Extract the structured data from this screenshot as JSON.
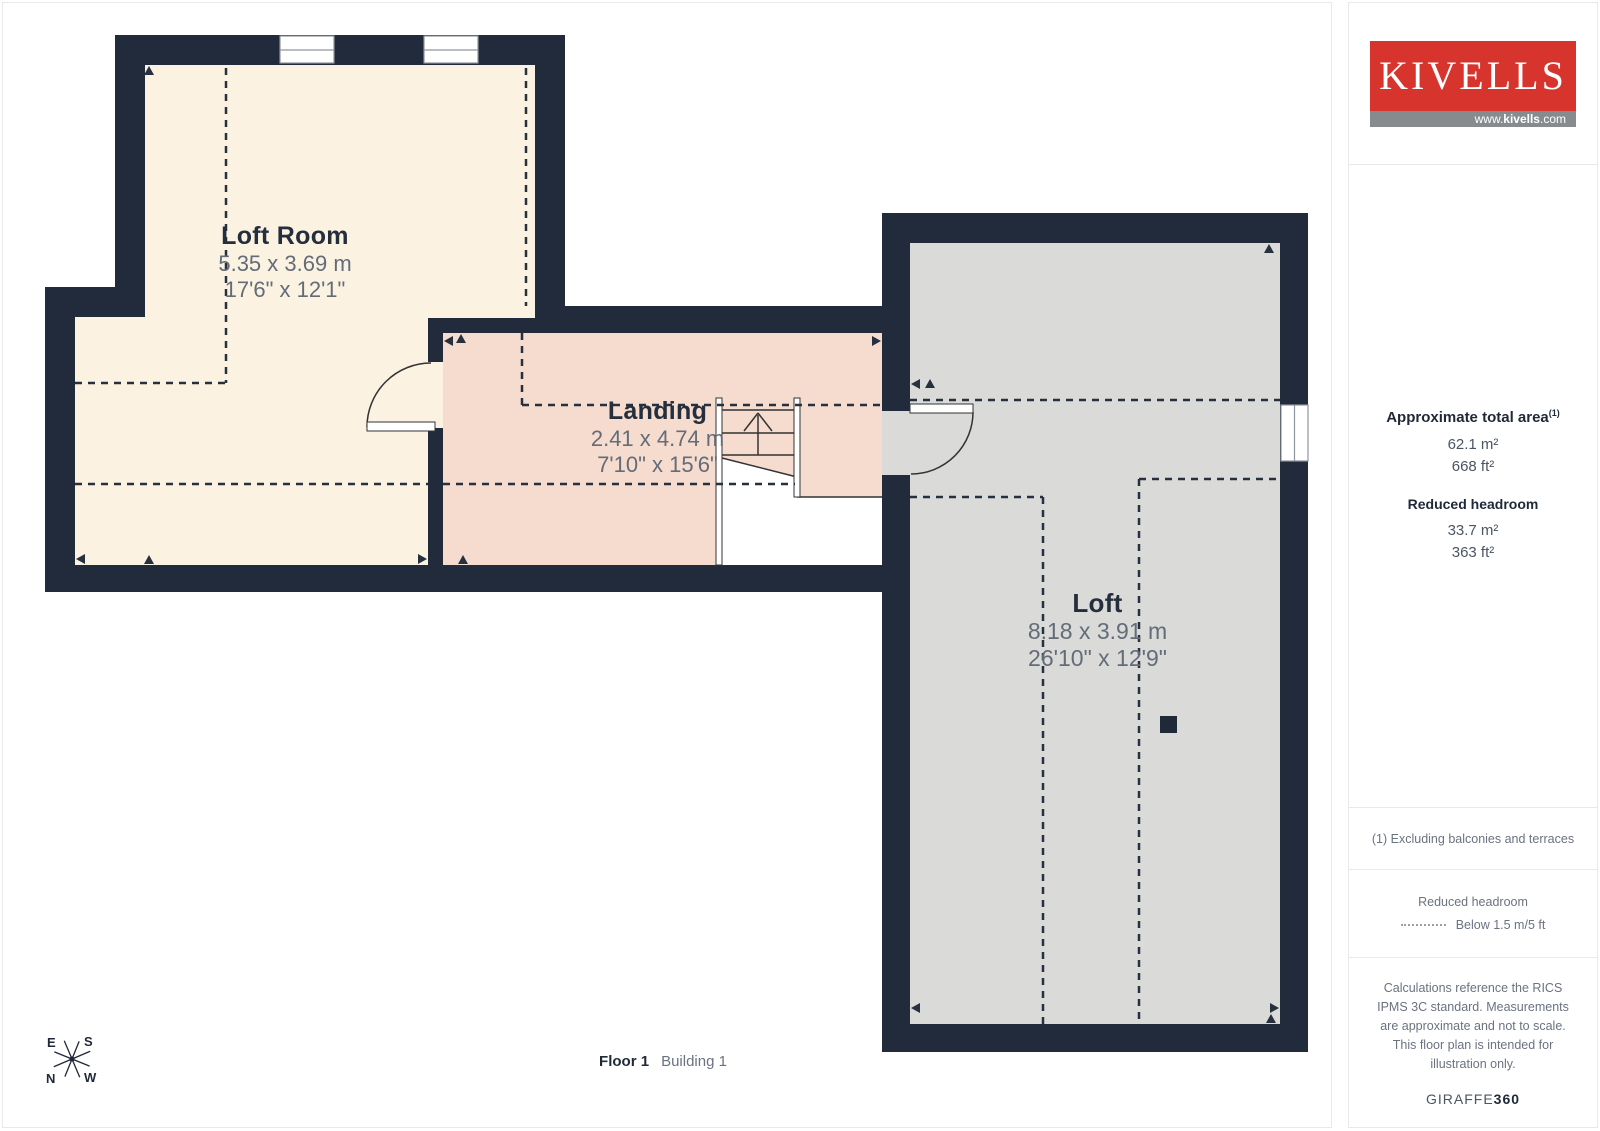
{
  "logo": {
    "brand": "KIVELLS",
    "website_prefix": "www.",
    "website_bold": "kivells",
    "website_suffix": ".com"
  },
  "rooms": [
    {
      "name": "Loft Room",
      "dim_metric": "5.35 x 3.69 m",
      "dim_imperial": "17'6\" x 12'1\""
    },
    {
      "name": "Landing",
      "dim_metric": "2.41 x 4.74 m",
      "dim_imperial": "7'10\" x 15'6\""
    },
    {
      "name": "Loft",
      "dim_metric": "8.18 x 3.91 m",
      "dim_imperial": "26'10\" x 12'9\""
    }
  ],
  "sidebar": {
    "area_title": "Approximate total area",
    "area_footnote_marker": "(1)",
    "area_m2": "62.1 m²",
    "area_ft2": "668 ft²",
    "reduced_headroom_title": "Reduced headroom",
    "reduced_m2": "33.7 m²",
    "reduced_ft2": "363 ft²",
    "footnote": "(1) Excluding balconies and terraces",
    "legend_title": "Reduced headroom",
    "legend_label": "Below 1.5 m/5 ft",
    "disclaimer": "Calculations reference the RICS IPMS 3C standard. Measurements are approximate and not to scale. This floor plan is intended for illustration only.",
    "credit_brand": "GIRAFFE",
    "credit_suffix": "360"
  },
  "footer": {
    "floor_label": "Floor 1",
    "building_label": "Building 1"
  },
  "compass": {
    "north": "N",
    "south": "S",
    "east": "E",
    "west": "W"
  },
  "colors": {
    "wall": "#212b3b",
    "loft_room_fill": "#fbf2e1",
    "landing_fill": "#f5dccf",
    "loft_fill": "#dadad8",
    "dash_line": "#26303f",
    "logo_red": "#d6342c",
    "logo_gray": "#888b8d"
  }
}
